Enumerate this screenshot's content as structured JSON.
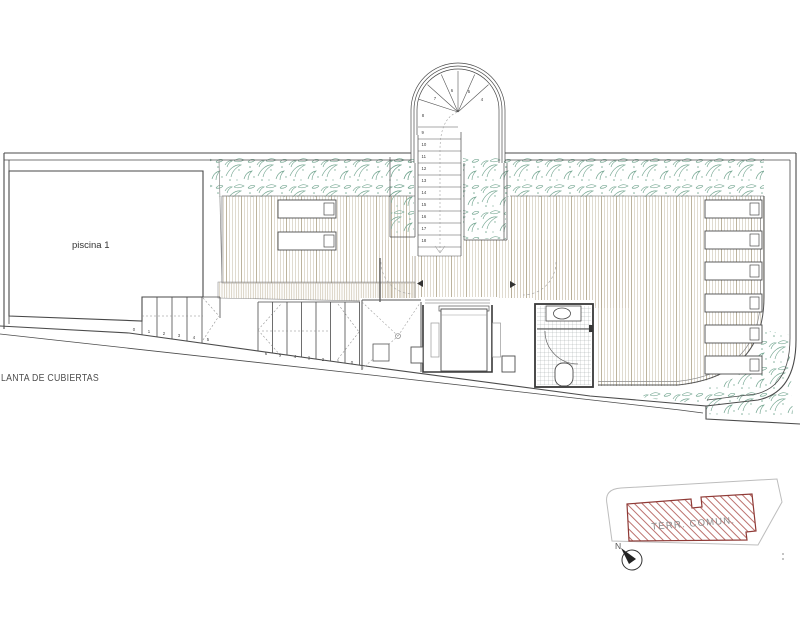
{
  "plan": {
    "title": "LANTA DE CUBIERTAS",
    "pool_label": "piscina 1",
    "flight_steps": [
      "9",
      "10",
      "11",
      "12",
      "13",
      "14",
      "15",
      "16",
      "17",
      "18"
    ],
    "winder_steps": [
      "8",
      "7",
      "6",
      "5",
      "4"
    ],
    "pool_steps": [
      "0",
      "1",
      "2",
      "3",
      "4",
      "5"
    ],
    "lower_steps": [
      "6",
      "5",
      "4",
      "3",
      "2",
      "1",
      "0"
    ]
  },
  "keyplan": {
    "label": "TERR. COMUN.",
    "north_label": "N"
  },
  "colors": {
    "line": "#4b4b4b",
    "wall": "#383838",
    "deck_hatch": "#d3ccbd",
    "vegetation": "#74a691",
    "keyplan_red": "#8f3a36",
    "keyplan_gray": "#bdbdbd"
  }
}
